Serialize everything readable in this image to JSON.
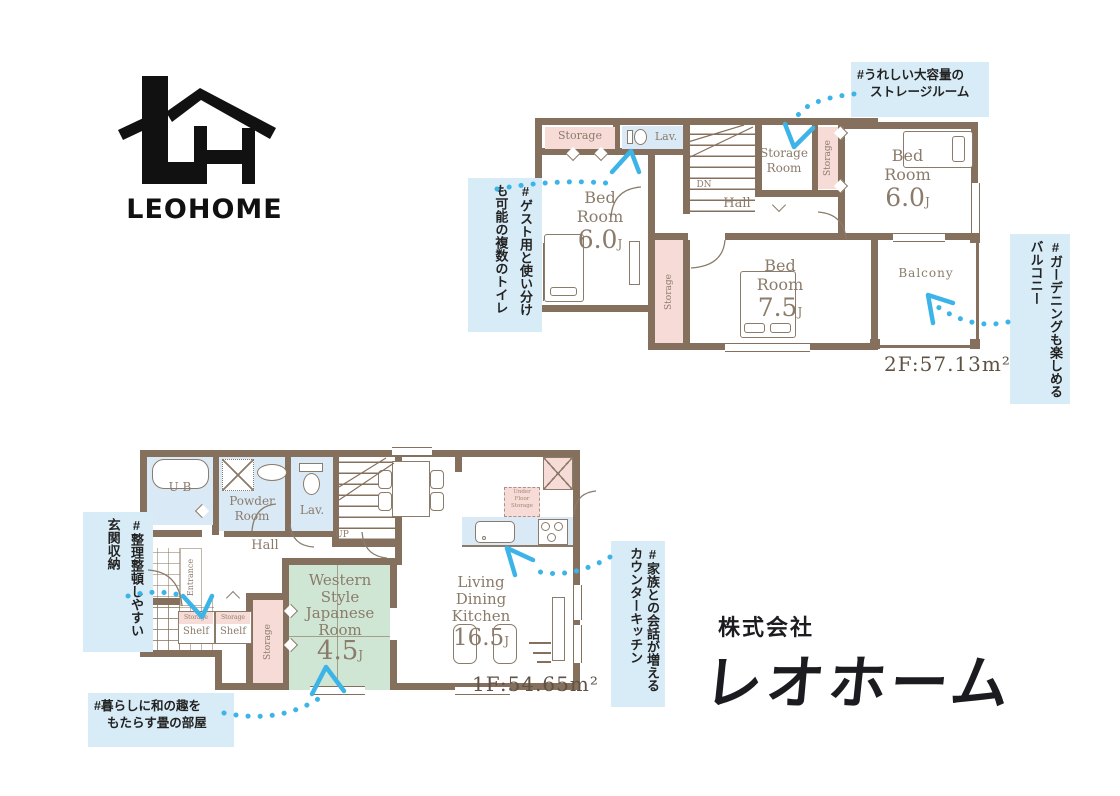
{
  "branding": {
    "wordmark": "LEOHOME",
    "company_prefix": "株式会社",
    "company_name": "レオホーム"
  },
  "floor2": {
    "area_label": "2F:57.13m²",
    "storage_top": "Storage",
    "lav": "Lav.",
    "stairs_down": "DN",
    "hall": "Hall",
    "storage_room": "Storage Room",
    "storage_strip_right": "Storage",
    "storage_strip_mid": "Storage",
    "balcony": "Balcony",
    "bedroom_top_right": {
      "name": "Bed Room",
      "size": "6.0",
      "unit": "J"
    },
    "bedroom_left": {
      "name": "Bed Room",
      "size": "6.0",
      "unit": "J"
    },
    "bedroom_bottom": {
      "name": "Bed Room",
      "size": "7.5",
      "unit": "J"
    }
  },
  "floor1": {
    "area_label": "1F:54.65m²",
    "unit_bath": "U B",
    "powder_room": "Powder Room",
    "lav": "Lav.",
    "stairs_up": "UP",
    "hall": "Hall",
    "entrance": "Entrance",
    "shelf_left": {
      "top": "Storage",
      "label": "Shelf"
    },
    "shelf_right": {
      "top": "Storage",
      "label": "Shelf"
    },
    "storage_strip": "Storage",
    "under_floor_storage": "Under Floor Storage",
    "japanese_room": {
      "name": "Western Style Japanese Room",
      "size": "4.5",
      "unit": "J"
    },
    "ldk": {
      "name": "Living Dining Kitchen",
      "size": "16.5",
      "unit": "J"
    }
  },
  "annotations": [
    {
      "id": "storage-room",
      "lines": [
        "#うれしい大容量の",
        "ストレージルーム"
      ]
    },
    {
      "id": "multiple-toilets",
      "lines": [
        "#ゲスト用と使い分け",
        "も可能の複数のトイレ"
      ]
    },
    {
      "id": "balcony-gardening",
      "lines": [
        "#ガーデニングも楽しめる",
        "バルコニー"
      ]
    },
    {
      "id": "entrance-storage",
      "lines": [
        "#整理整頓しやすい",
        "玄関収納"
      ]
    },
    {
      "id": "tatami-room",
      "lines": [
        "#暮らしに和の趣を",
        "もたらす畳の部屋"
      ]
    },
    {
      "id": "counter-kitchen",
      "lines": [
        "#家族との会話が増える",
        "カウンターキッチン"
      ]
    }
  ],
  "colors": {
    "wall": "#84705c",
    "room_pink": "#f7dbd6",
    "room_blue": "#d9e9f5",
    "room_green": "#cfe6d4",
    "annotation_bg": "#d8ecf7",
    "arrow_blue": "#3db4e8",
    "plan_text": "#8b7b6b",
    "area_text": "#5f5244",
    "logo_black": "#111111"
  }
}
